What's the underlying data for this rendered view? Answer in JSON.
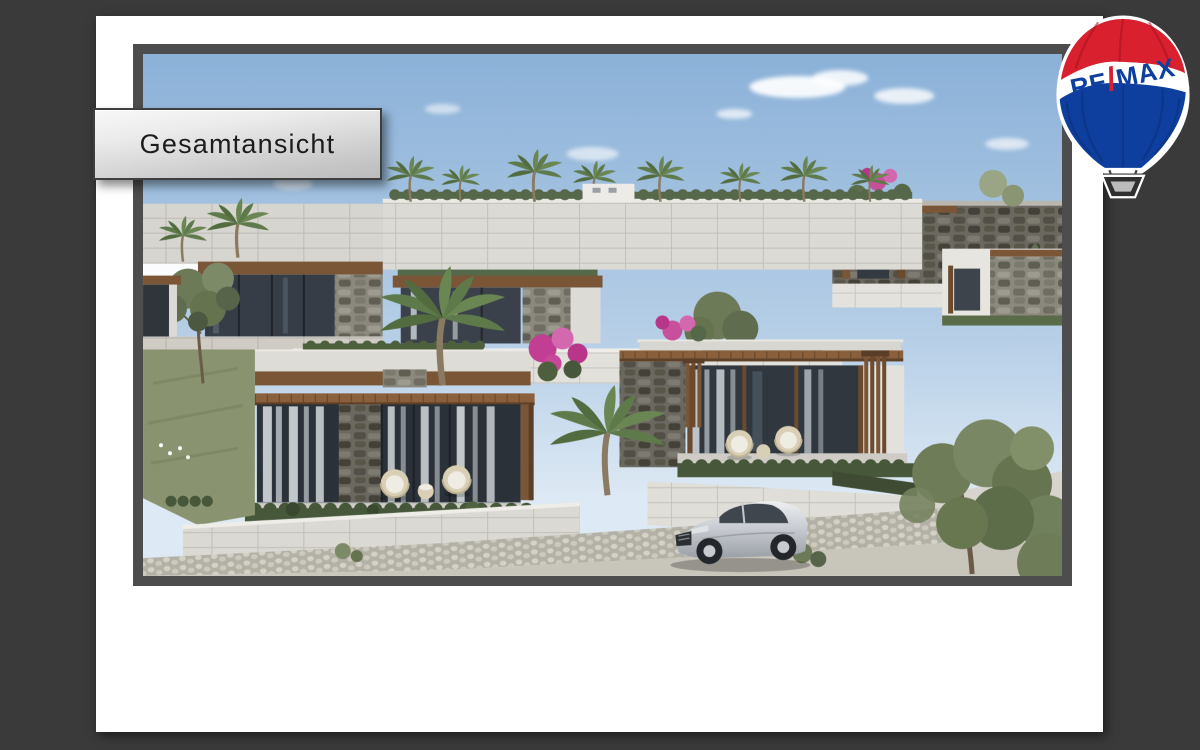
{
  "page": {
    "background": "#3a3a3a"
  },
  "slide": {
    "background": "#ffffff"
  },
  "banner": {
    "label": "Gesamtansicht"
  },
  "logo": {
    "name": "remax-hot-air-balloon",
    "brand_re": "RE",
    "brand_slash": "/",
    "brand_max": "MAX",
    "red": "#d8202f",
    "red_dark": "#a81320",
    "blue": "#0e3f9e",
    "blue_dark": "#0a2f78",
    "basket": "#bbbbbb"
  },
  "photo": {
    "alt": "Architectural rendering: terraced modern stone villas with flat roofs, wood pergolas, rooftop palm trees, pink bougainvillea, light retaining walls, cobblestone driveway and a silver sports car under a blue sky",
    "frame_color": "#4d4d4d",
    "sky_top": "#8bb1d8",
    "sky_mid": "#b7cfe7",
    "sky_bottom": "#dde9f4",
    "stone_light": "#dcdad4",
    "wood": "#7a5637",
    "hedge": "#46573a",
    "flower_pink": "#c7479b",
    "car_silver": "#c6cad0"
  }
}
